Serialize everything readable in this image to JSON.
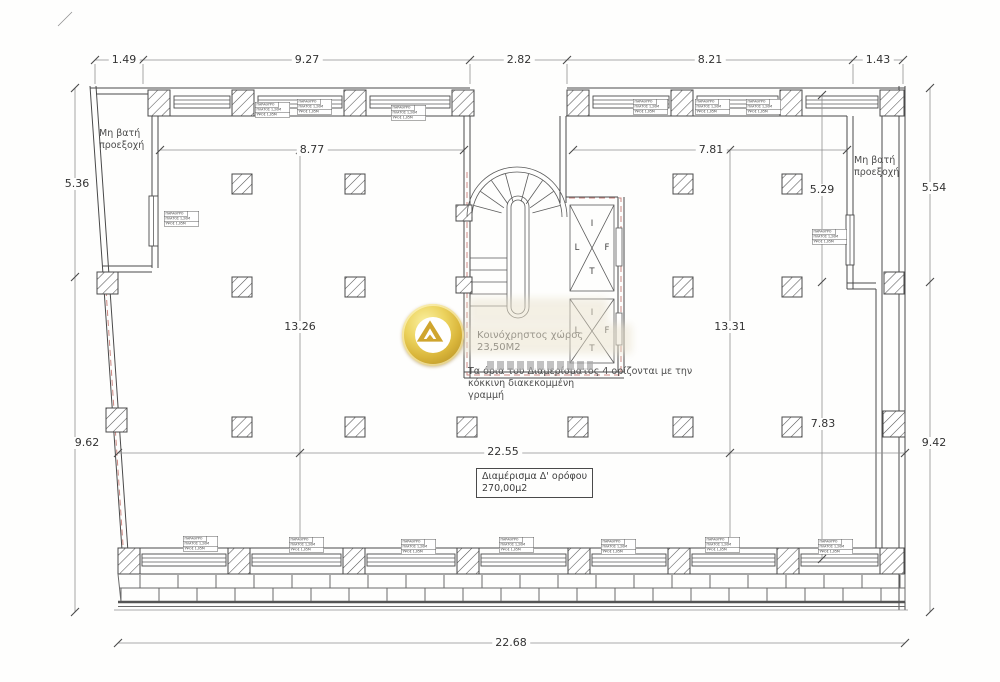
{
  "dims": {
    "top": [
      "1.49",
      "9.27",
      "2.82",
      "8.21",
      "1.43"
    ],
    "left": [
      "5.36",
      "9.62"
    ],
    "right": [
      "5.54",
      "9.42"
    ],
    "bottom": [
      "22.68"
    ],
    "inner": [
      "8.77",
      "7.81",
      "13.26",
      "13.31",
      "5.29",
      "7.83",
      "22.55"
    ]
  },
  "labels": {
    "no_access": [
      "Μη βατή",
      "προεξοχή"
    ],
    "common_area": [
      "Κοινόχρηστος χώρος",
      "23,50Μ2"
    ],
    "boundary_note": [
      "Τα όρια του Διαμερίσματος 4 ορίζονται με την",
      "κόκκινη διακεκομμένη",
      "γραμμή"
    ],
    "apartment": [
      "Διαμέρισμα Δ' ορόφου",
      "270,00μ2"
    ],
    "lift_letters": [
      "I",
      "L",
      "F",
      "T"
    ]
  },
  "window_tag": [
    "ΠΑΡΑΘΥΡΟ",
    "ΠΛΑΤΟΣ 1,20Μ",
    "ΥΨΟΣ 1,05Μ"
  ],
  "colors": {
    "wall": "#4a4a4a",
    "thin_line": "#8f8f8f",
    "red_dash": "#c4736c",
    "gold": "#d9b53a"
  }
}
